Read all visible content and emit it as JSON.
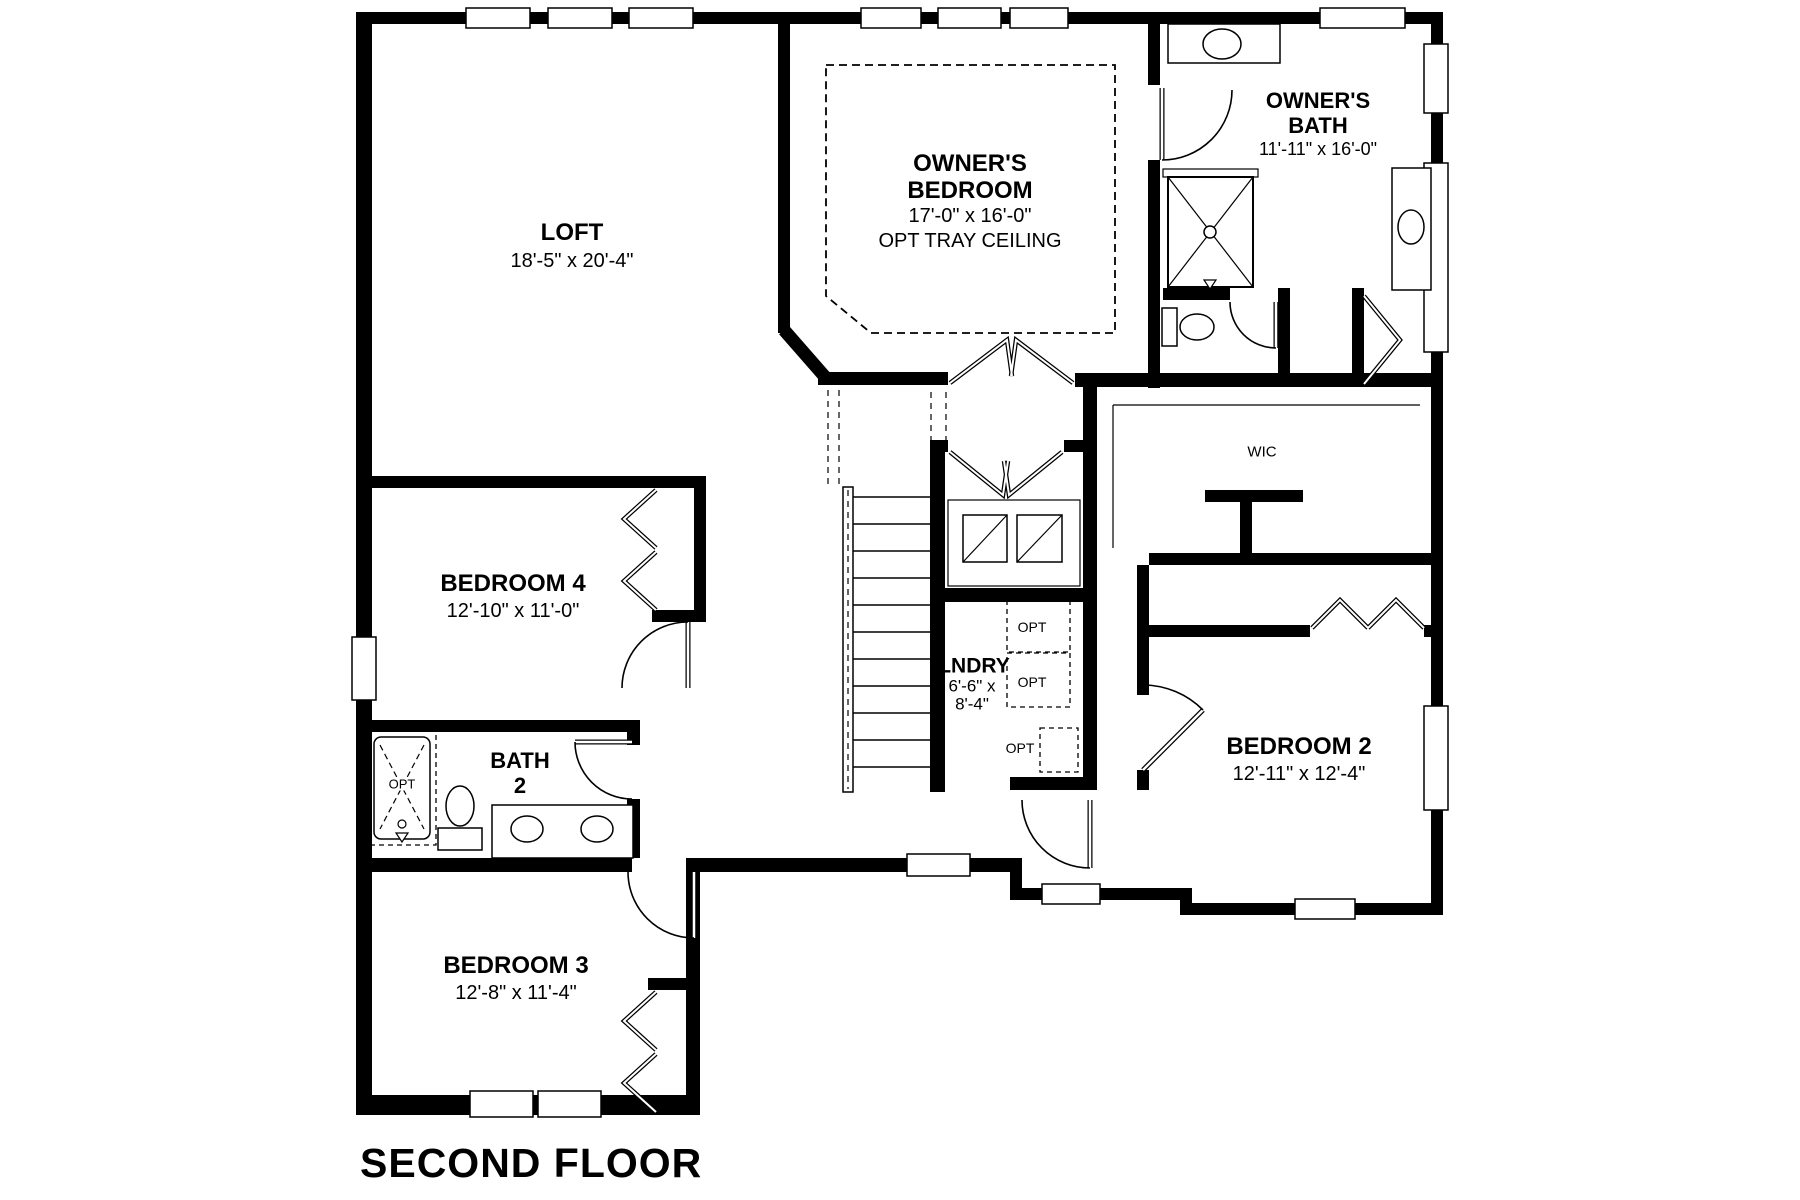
{
  "page": {
    "title": "SECOND FLOOR",
    "background_color": "#ffffff",
    "wall_color": "#000000"
  },
  "rooms": {
    "loft": {
      "name": "LOFT",
      "dims": "18'-5\" x 20'-4\""
    },
    "owners_bedroom": {
      "name_line1": "OWNER'S",
      "name_line2": "BEDROOM",
      "dims": "17'-0\" x 16'-0\"",
      "note": "OPT TRAY CEILING"
    },
    "owners_bath": {
      "name_line1": "OWNER'S",
      "name_line2": "BATH",
      "dims": "11'-11\" x 16'-0\""
    },
    "bedroom_4": {
      "name": "BEDROOM 4",
      "dims": "12'-10\" x 11'-0\""
    },
    "bath_2": {
      "name_line1": "BATH",
      "name_line2": "2"
    },
    "bedroom_3": {
      "name": "BEDROOM 3",
      "dims": "12'-8\" x 11'-4\""
    },
    "bedroom_2": {
      "name": "BEDROOM 2",
      "dims": "12'-11\" x 12'-4\""
    },
    "laundry": {
      "name": "LNDRY",
      "dims_line1": "6'-6\" x",
      "dims_line2": "8'-4\""
    },
    "wic": {
      "name": "WIC"
    }
  },
  "annotations": {
    "opt_tub": "OPT",
    "opt_laundry_1": "OPT",
    "opt_laundry_2": "OPT",
    "opt_laundry_3": "OPT"
  }
}
